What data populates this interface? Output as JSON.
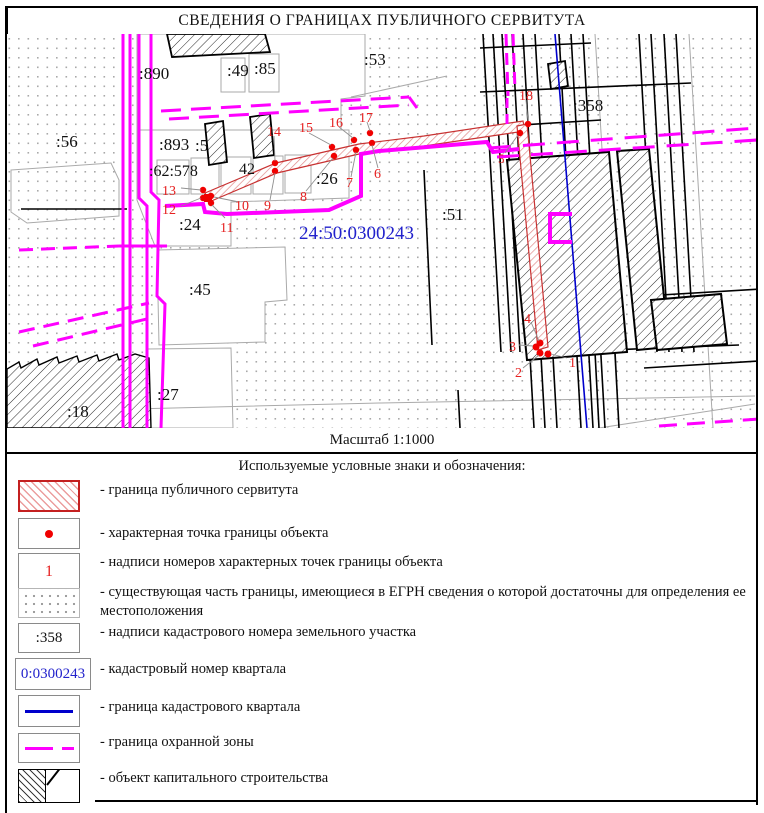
{
  "title": "СВЕДЕНИЯ О ГРАНИЦАХ ПУБЛИЧНОГО СЕРВИТУТА",
  "scale_label": "Масштаб 1:1000",
  "map": {
    "quarter_number": "24:50:0300243",
    "parcel_labels": [
      ":890",
      ":49",
      ":85",
      ":53",
      ":56",
      ":893",
      ":5",
      ":62:578",
      "42",
      ":26",
      ":24",
      ":51",
      ":45",
      ":27",
      ":18",
      ":358"
    ],
    "point_labels": [
      "1",
      "2",
      "3",
      "4",
      "5",
      "6",
      "7",
      "8",
      "9",
      "10",
      "11",
      "12",
      "13",
      "14",
      "15",
      "16",
      "17",
      "18"
    ]
  },
  "legend": {
    "header": "Используемые условные знаки и обозначения:",
    "items": [
      {
        "label": "- граница публичного сервитута"
      },
      {
        "label": "- характерная точка границы объекта"
      },
      {
        "symbol_text": "1",
        "label": "- надписи номеров характерных точек границы объекта"
      },
      {
        "label": "- существующая часть границы, имеющиеся в ЕГРН сведения о которой достаточны для определения ее местоположения"
      },
      {
        "symbol_text": ":358",
        "label": "- надписи кадастрового номера земельного участка"
      },
      {
        "symbol_text": "0:0300243",
        "label": "- кадастровый номер квартала"
      },
      {
        "label": "- граница кадастрового квартала"
      },
      {
        "label": "- граница охранной зоны"
      },
      {
        "label": "- объект капитального строительства"
      }
    ]
  },
  "colors": {
    "servitude_red": "#c42020",
    "point_red": "#f00000",
    "protection_zone_magenta": "#ff00ff",
    "quarter_boundary_blue": "#0000cc",
    "quarter_number_blue": "#2222cc"
  }
}
